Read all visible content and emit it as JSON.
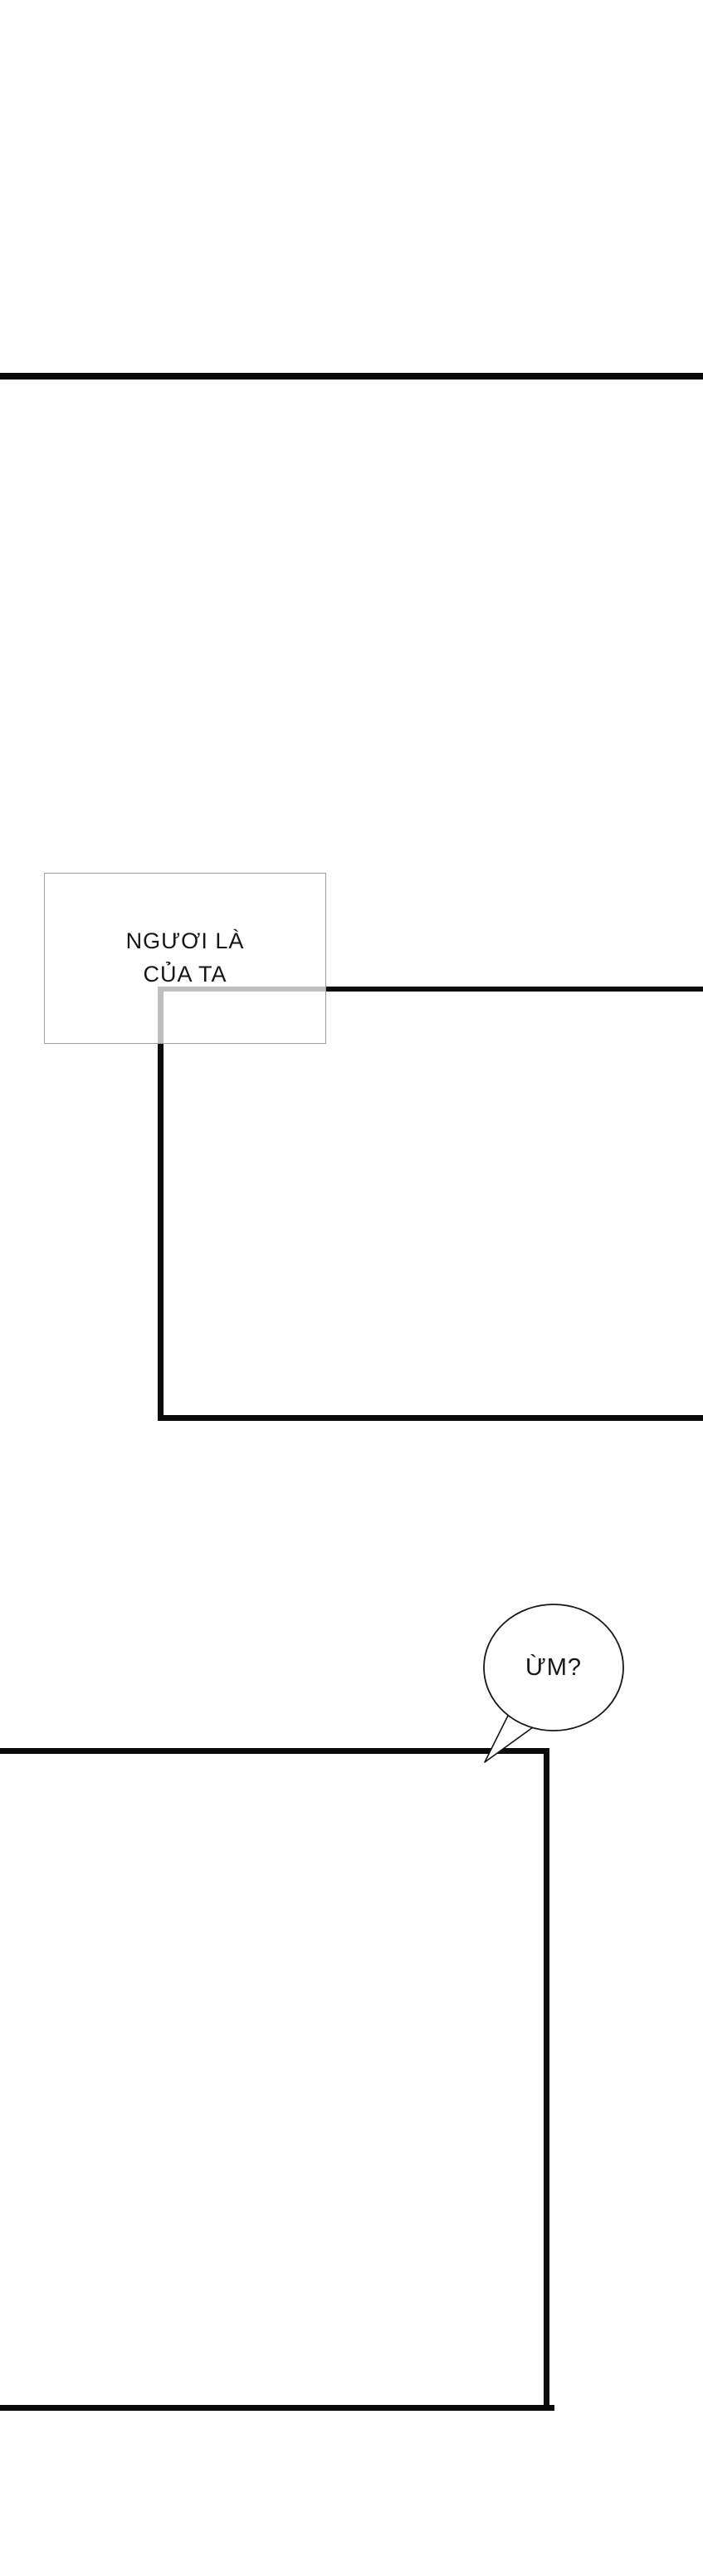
{
  "colors": {
    "background": "#ffffff",
    "ink": "#0b0b0b",
    "caption_border": "#9e9e9e"
  },
  "caption_box": {
    "lines": [
      "NGƯƠI LÀ",
      "CỦA TA"
    ]
  },
  "speech_bubble": {
    "text": "ỪM?"
  }
}
